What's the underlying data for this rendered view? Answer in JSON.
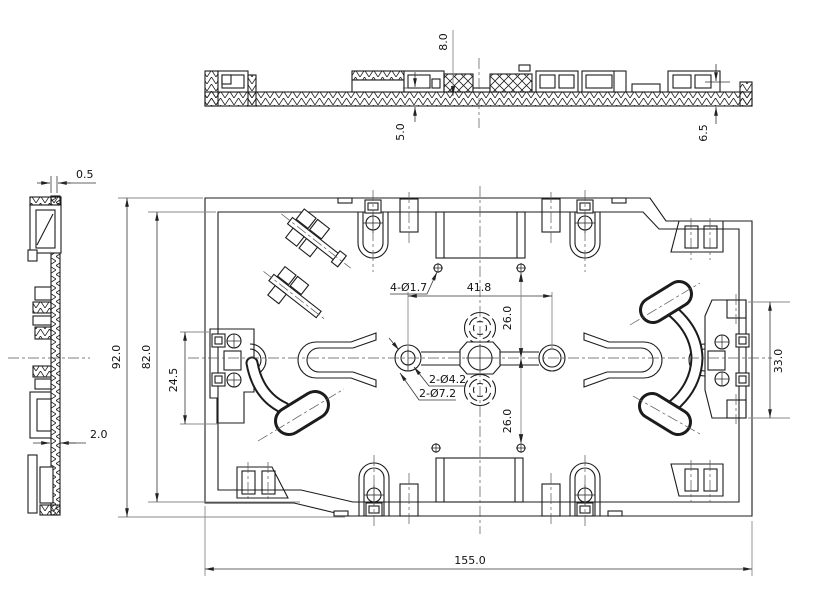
{
  "canvas": {
    "background": "#ffffff",
    "line_color": "#1c1c1c",
    "dim_color": "#333333"
  },
  "views": {
    "section": {
      "dim_boss_height": "8.0",
      "dim_base_thickness": "5.0",
      "dim_edge_height": "6.5"
    },
    "side": {
      "dim_wall_thickness": "0.5",
      "dim_web_thickness": "2.0"
    },
    "plan": {
      "dim_overall_height": "92.0",
      "dim_inner_height": "82.0",
      "dim_bracket_height": "24.5",
      "dim_hole_span": "41.8",
      "dim_pitch_upper": "26.0",
      "dim_pitch_lower": "26.0",
      "dim_right_bracket_height": "33.0",
      "dim_overall_width": "155.0",
      "callout_small_holes": "4-Ø1.7",
      "callout_mid_holes": "2-Ø4.2",
      "callout_large_holes": "2-Ø7.2"
    }
  }
}
